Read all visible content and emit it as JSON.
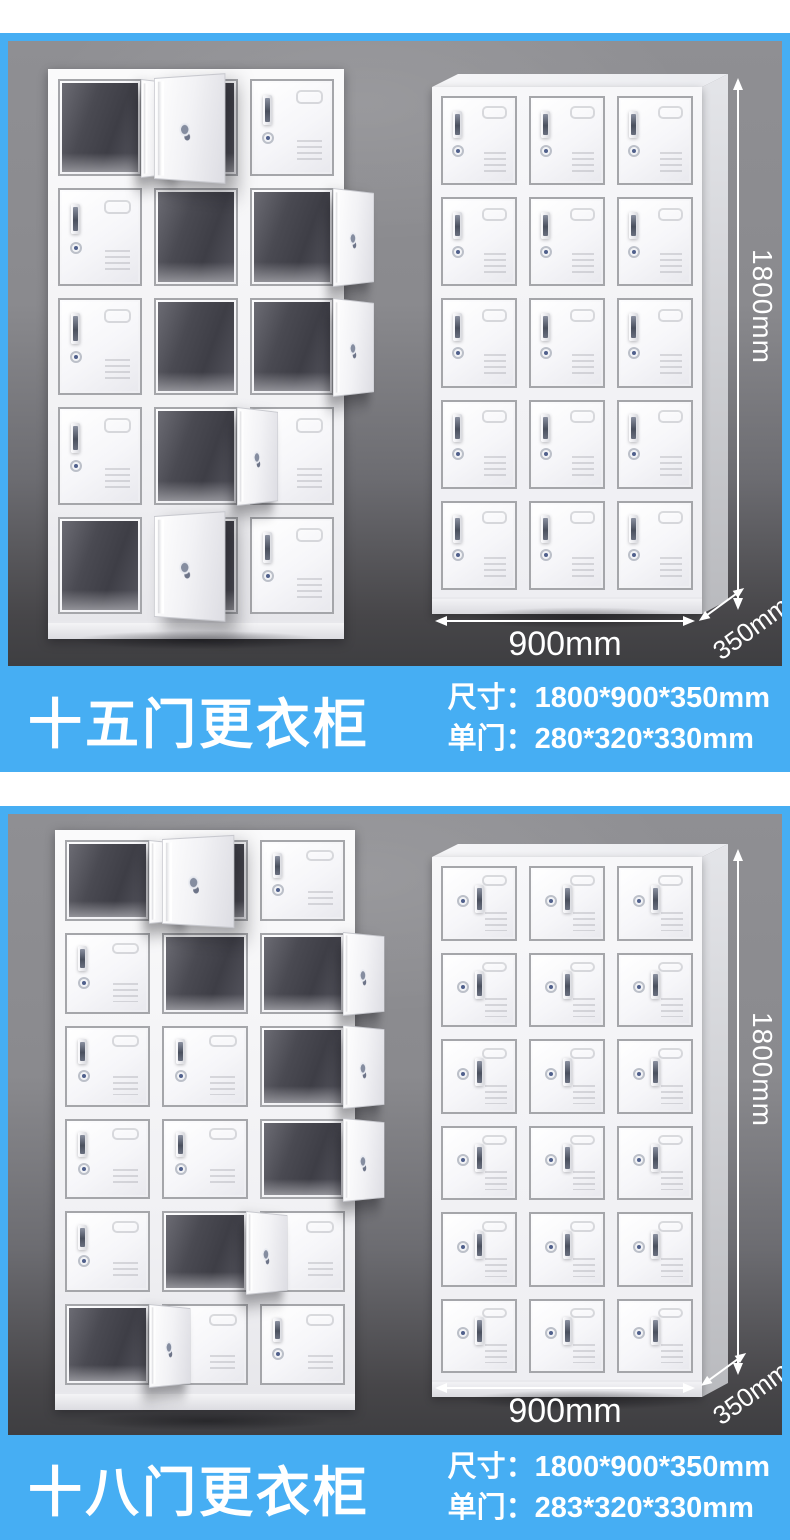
{
  "theme": {
    "banner_blue": "#46aef3",
    "card_frame_blue": "#46aef3",
    "page_background": "#ffffff",
    "card_gray_top": "#8f8f93",
    "card_gray_bottom": "#3e3e41",
    "dimension_text_color": "#ffffff"
  },
  "sections": [
    {
      "banner": {
        "title": "十五门更衣柜",
        "spec_size": "尺寸：1800*900*350mm",
        "spec_door": "单门：280*320*330mm"
      },
      "dims": {
        "height": "1800mm",
        "width": "900mm",
        "depth": "350mm"
      },
      "open_locker": {
        "rows": 5,
        "cols": 3,
        "door_grid": [
          [
            "oR",
            "aL",
            "c"
          ],
          [
            "c",
            "o",
            "oR"
          ],
          [
            "c",
            "o",
            "oR"
          ],
          [
            "c",
            "oR",
            "c"
          ],
          [
            "o",
            "aL",
            "c"
          ]
        ]
      },
      "closed_locker": {
        "rows": 5,
        "cols": 3
      }
    },
    {
      "banner": {
        "title": "十八门更衣柜",
        "spec_size": "尺寸：1800*900*350mm",
        "spec_door": "单门：283*320*330mm"
      },
      "dims": {
        "height": "1800mm",
        "width": "900mm",
        "depth": "350mm"
      },
      "open_locker": {
        "rows": 6,
        "cols": 3,
        "door_grid": [
          [
            "oR",
            "aL",
            "c"
          ],
          [
            "c",
            "o",
            "oR"
          ],
          [
            "c",
            "c",
            "oR"
          ],
          [
            "c",
            "c",
            "oR"
          ],
          [
            "c",
            "oR",
            "c"
          ],
          [
            "oR",
            "c",
            "c"
          ]
        ]
      },
      "closed_locker": {
        "rows": 6,
        "cols": 3
      }
    }
  ]
}
